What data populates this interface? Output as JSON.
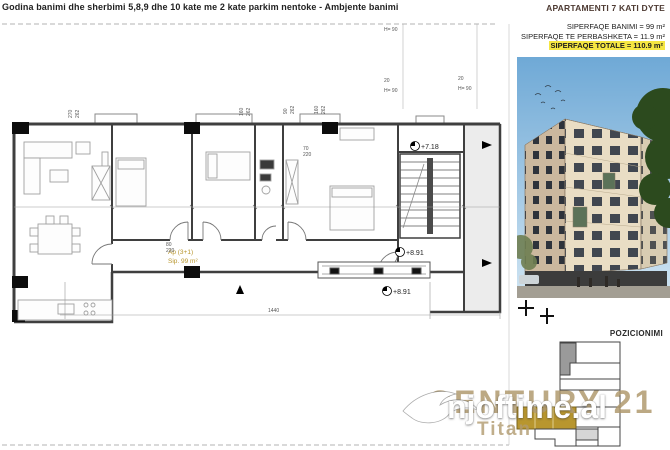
{
  "header": {
    "title": "Godina  banimi dhe sherbimi 5,8,9 dhe 10 kate me 2 kate parkim  nentoke - Ambjente banimi",
    "apartment_title": "APARTAMENTI 7 KATI DYTE",
    "area_line1": "SIPERFAQE BANIMI = 99 m²",
    "area_line2": "SIPERFAQE TE PERBASHKETA = 11.9 m²",
    "area_line3": "SIPERFAQE TOTALE = 110.9 m²"
  },
  "plan": {
    "unit_type": "Ap (3+1)",
    "unit_area": "Sip. 99 m²",
    "elevation_upper": "+7.18",
    "elevation_mid": "+8.91",
    "elevation_lower": "+8.91",
    "dims": {
      "top_pair1_w": "270",
      "top_pair1_h": "262",
      "top_pair2_w": "160",
      "top_pair2_h": "262",
      "top_pair3_w": "90",
      "top_pair3_h": "262",
      "top_pair4_w": "160",
      "top_pair4_h": "262",
      "bottom_total": "1440",
      "parapet_top": "H= 90",
      "parapet_gap": "20",
      "parapet_mid": "H= 90",
      "parapet_gap2": "20",
      "parapet_right": "H= 90",
      "door1_w": "70",
      "door1_h": "220",
      "door2_w": "80",
      "door2_h": "220"
    }
  },
  "right_panel": {
    "position_label": "POZICIONIMI"
  },
  "watermarks": {
    "agency_name": "CENTURY 21",
    "agency_office": "Titan",
    "portal": "njoftime.al"
  },
  "colors": {
    "unit_highlight_gold": "#b8962e",
    "total_area_highlight": "#f5e642",
    "agency_watermark_tan": "#b09a6e",
    "plan_lines": "#3f3f3f",
    "corridor_fill": "#ececec"
  }
}
